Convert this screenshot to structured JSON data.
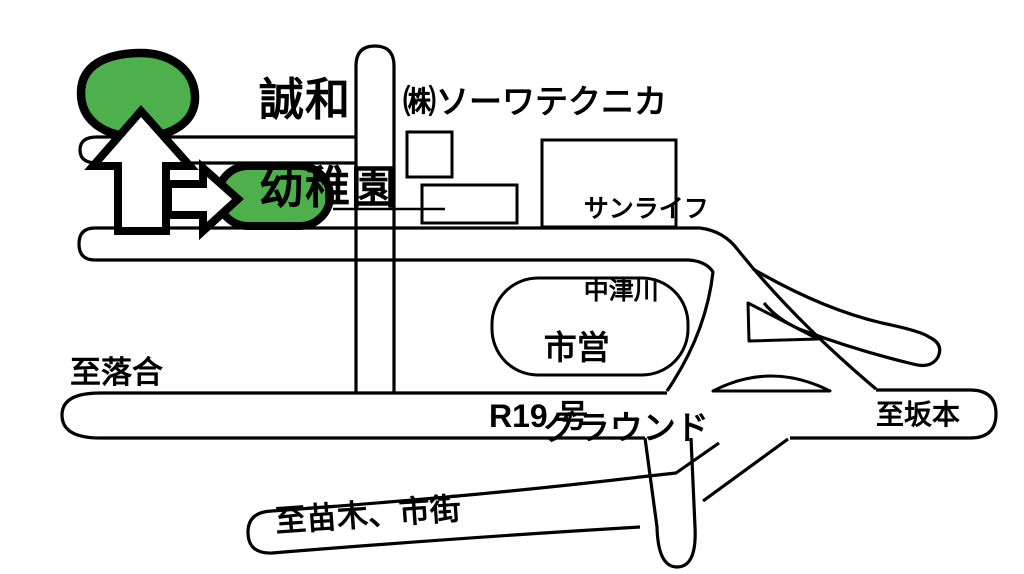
{
  "map": {
    "title": {
      "line1": "誠和",
      "line2": "幼稚園"
    },
    "landmarks": {
      "company": "㈱ソーワテクニカ",
      "sunlife": {
        "line1": "サンライフ",
        "line2": "中津川"
      },
      "ground": {
        "line1": "市営",
        "line2": "グラウンド"
      }
    },
    "directions": {
      "west": "至落合",
      "east": "至坂本",
      "south": "至苗木、市街"
    },
    "route_label": "R19 号",
    "colors": {
      "site_green": "#4db04c",
      "line": "#000000",
      "background": "#ffffff"
    }
  }
}
